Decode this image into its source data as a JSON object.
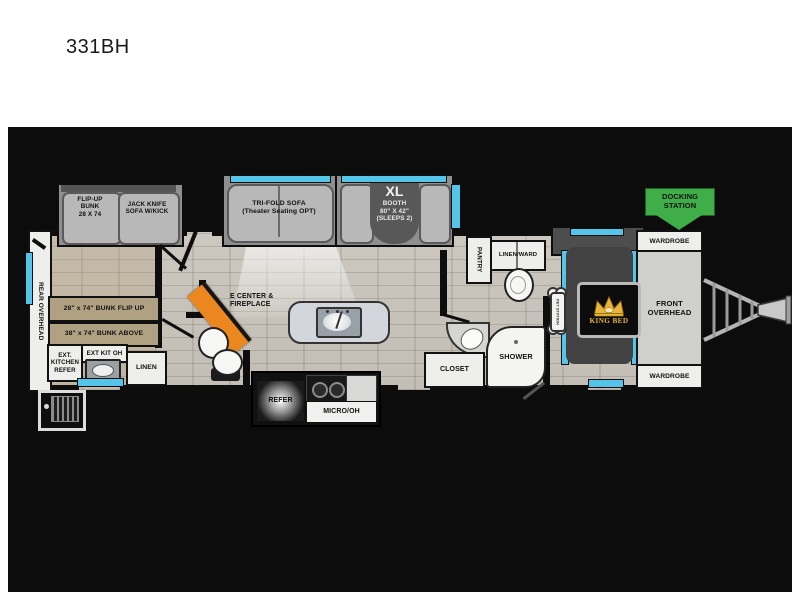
{
  "title": "331BH",
  "colors": {
    "accent_blue": "#55c4e9",
    "docking_green": "#3fae49",
    "fireplace_orange": "#ea871f",
    "bunk_tan": "#b1a183",
    "crown_gold": "#e9b63a"
  },
  "slides": {
    "flip_up_bunk_label": "FLIP-UP\nBUNK\n28 X 74",
    "jack_knife_label": "JACK KNIFE\nSOFA W/KICK",
    "tri_fold_label": "TRI-FOLD SOFA\n(Theater Seating OPT)",
    "booth_xl": "XL",
    "booth_lines": "BOOTH\n80\" X 42\"\n(SLEEPS 2)"
  },
  "bunkhouse": {
    "rear_overhead": "REAR OVERHEAD",
    "bunk_flip_up": "28\" x 74\" BUNK FLIP UP",
    "bunk_above": "38\" x 74\" BUNK ABOVE",
    "ext_kitchen_refer": "EXT.\nKITCHEN\nREFER",
    "ext_kit_oh": "EXT KIT OH",
    "linen": "LINEN"
  },
  "living": {
    "e_center": "E CENTER &\nFIREPLACE"
  },
  "kitchen": {
    "refer": "REFER",
    "micro_oh": "MICRO/OH"
  },
  "bath": {
    "pantry": "PANTRY",
    "linen_ward": "LINEN/WARD",
    "closet": "CLOSET",
    "shower": "SHOWER"
  },
  "bedroom": {
    "king_bed": "KING BED",
    "pet_station": "PET STATION",
    "front_overhead": "FRONT\nOVERHEAD",
    "wardrobe_top": "WARDROBE",
    "wardrobe_bottom": "WARDROBE"
  },
  "exterior": {
    "docking_station": "DOCKING\nSTATION"
  }
}
